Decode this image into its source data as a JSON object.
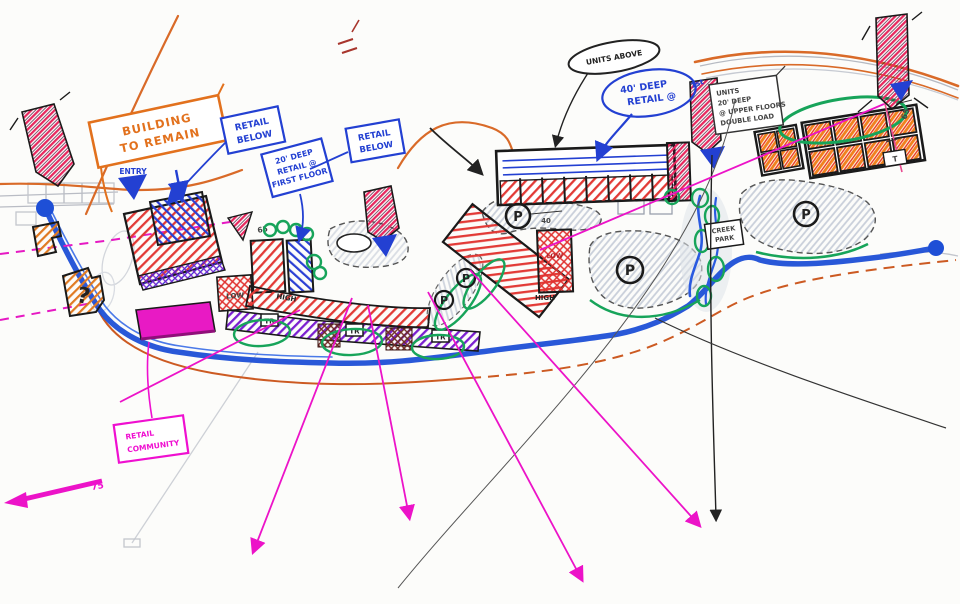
{
  "document": {
    "type": "hand-drawn site plan concept sketch"
  },
  "palette": {
    "red": "#e0312f",
    "crimson": "#e8265e",
    "blue": "#2340d2",
    "magenta": "#ef0fd0",
    "orange": "#e2711d",
    "green": "#17a45a",
    "purple": "#7a1fd0",
    "maroon": "#6e2a24",
    "gray": "#9aa0ad"
  },
  "callouts": {
    "building_to_remain": {
      "line1": "BUILDING",
      "line2": "TO REMAIN"
    },
    "retail_below_left": {
      "line1": "RETAIL",
      "line2": "BELOW"
    },
    "retail_20_deep": {
      "line1": "20' DEEP",
      "line2": "RETAIL @",
      "line3": "FIRST FLOOR"
    },
    "retail_below_mid": {
      "line1": "RETAIL",
      "line2": "BELOW"
    },
    "units_above": {
      "text": "UNITS ABOVE"
    },
    "retail_40_deep": {
      "line1": "40' DEEP",
      "line2": "RETAIL @",
      "line3": "1st"
    },
    "units_upper_floors": {
      "line1": "UNITS",
      "line2": "20' DEEP",
      "line3": "@ UPPER FLOORS",
      "line4": "DOUBLE LOAD"
    },
    "retail_community": {
      "line1": "RETAIL",
      "line2": "COMMUNITY"
    },
    "entry": {
      "text": "ENTRY"
    },
    "creek_park": {
      "line1": "CREEK",
      "line2": "PARK"
    }
  },
  "plan_labels": {
    "parking": "P",
    "trash": "TR",
    "high": "HIGH",
    "low": "LOW",
    "question_mark": "?",
    "dim_65": "65",
    "dim_40": "40",
    "dim_75": "75",
    "dim_t": "T"
  }
}
